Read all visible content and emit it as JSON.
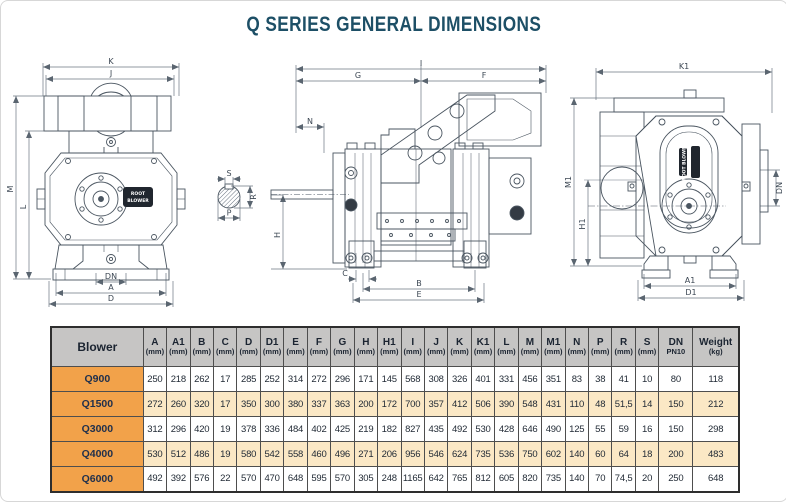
{
  "title": "Q SERIES GENERAL DIMENSIONS",
  "colors": {
    "title_text": "#1d4f66",
    "header_bg": "#c6c5c4",
    "blower_cell_bg": "#f2a24a",
    "alt_row_bg": "#fbe8c5",
    "table_border": "#4e4e4e",
    "drawing_line": "#4a5560",
    "dim_line": "#6b7682"
  },
  "drawings": {
    "front": {
      "k": "K",
      "j": "J",
      "m": "M",
      "l": "L",
      "dn": "DN",
      "a": "A",
      "d": "D",
      "brand_line1": "ROOT",
      "brand_line2": "BLOWER"
    },
    "shaft": {
      "s": "S",
      "r": "R",
      "p": "P"
    },
    "side": {
      "i": "I",
      "g": "G",
      "f": "F",
      "n": "N",
      "h": "H",
      "c": "C",
      "b": "B",
      "e": "E"
    },
    "end": {
      "k1": "K1",
      "m1": "M1",
      "h1": "H1",
      "dn": "DN",
      "a1": "A1",
      "d1": "D1",
      "brand": "ROOT BLOWER"
    }
  },
  "table": {
    "corner_label": "Blower",
    "columns": [
      {
        "letter": "A",
        "unit": "(mm)"
      },
      {
        "letter": "A1",
        "unit": "(mm)"
      },
      {
        "letter": "B",
        "unit": "(mm)"
      },
      {
        "letter": "C",
        "unit": "(mm)"
      },
      {
        "letter": "D",
        "unit": "(mm)"
      },
      {
        "letter": "D1",
        "unit": "(mm)"
      },
      {
        "letter": "E",
        "unit": "(mm)"
      },
      {
        "letter": "F",
        "unit": "(mm)"
      },
      {
        "letter": "G",
        "unit": "(mm)"
      },
      {
        "letter": "H",
        "unit": "(mm)"
      },
      {
        "letter": "H1",
        "unit": "(mm)"
      },
      {
        "letter": "I",
        "unit": "(mm)"
      },
      {
        "letter": "J",
        "unit": "(mm)"
      },
      {
        "letter": "K",
        "unit": "(mm)"
      },
      {
        "letter": "K1",
        "unit": "(mm)"
      },
      {
        "letter": "L",
        "unit": "(mm)"
      },
      {
        "letter": "M",
        "unit": "(mm)"
      },
      {
        "letter": "M1",
        "unit": "(mm)"
      },
      {
        "letter": "N",
        "unit": "(mm)"
      },
      {
        "letter": "P",
        "unit": "(mm)"
      },
      {
        "letter": "R",
        "unit": "(mm)"
      },
      {
        "letter": "S",
        "unit": "(mm)"
      },
      {
        "letter": "DN",
        "unit": "PN10"
      },
      {
        "letter": "Weight",
        "unit": "(kg)"
      }
    ],
    "rows": [
      {
        "name": "Q900",
        "values": [
          "250",
          "218",
          "262",
          "17",
          "285",
          "252",
          "314",
          "272",
          "296",
          "171",
          "145",
          "568",
          "308",
          "326",
          "401",
          "331",
          "456",
          "351",
          "83",
          "38",
          "41",
          "10",
          "80",
          "118"
        ]
      },
      {
        "name": "Q1500",
        "values": [
          "272",
          "260",
          "320",
          "17",
          "350",
          "300",
          "380",
          "337",
          "363",
          "200",
          "172",
          "700",
          "357",
          "412",
          "506",
          "390",
          "548",
          "431",
          "110",
          "48",
          "51,5",
          "14",
          "150",
          "212"
        ]
      },
      {
        "name": "Q3000",
        "values": [
          "312",
          "296",
          "420",
          "19",
          "378",
          "336",
          "484",
          "402",
          "425",
          "219",
          "182",
          "827",
          "435",
          "492",
          "530",
          "428",
          "646",
          "490",
          "125",
          "55",
          "59",
          "16",
          "150",
          "298"
        ]
      },
      {
        "name": "Q4000",
        "values": [
          "530",
          "512",
          "486",
          "19",
          "580",
          "542",
          "558",
          "460",
          "496",
          "271",
          "206",
          "956",
          "546",
          "624",
          "735",
          "536",
          "750",
          "602",
          "140",
          "60",
          "64",
          "18",
          "200",
          "483"
        ]
      },
      {
        "name": "Q6000",
        "values": [
          "492",
          "392",
          "576",
          "22",
          "570",
          "470",
          "648",
          "595",
          "570",
          "305",
          "248",
          "1165",
          "642",
          "765",
          "812",
          "605",
          "820",
          "735",
          "140",
          "70",
          "74,5",
          "20",
          "250",
          "648"
        ]
      }
    ]
  }
}
